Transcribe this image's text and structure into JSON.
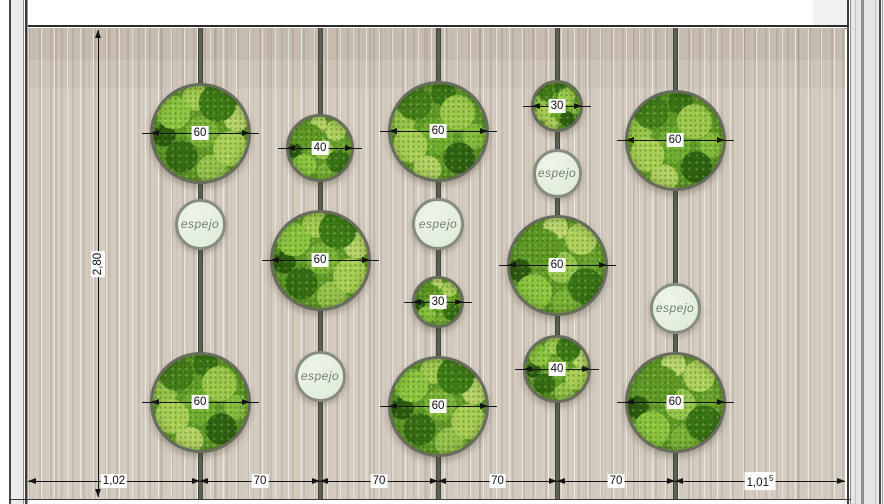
{
  "drawing": {
    "wall_height_dim": "2,80",
    "bottom_dims": [
      {
        "text": "1,02",
        "sup": ""
      },
      {
        "text": "70",
        "sup": ""
      },
      {
        "text": "70",
        "sup": ""
      },
      {
        "text": "70",
        "sup": ""
      },
      {
        "text": "70",
        "sup": ""
      },
      {
        "text": "1,01",
        "sup": "5"
      }
    ],
    "mirror_label": "espejo",
    "moss_diameter_labels": [
      "60",
      "40",
      "30"
    ]
  },
  "panels": [
    {
      "column": 1,
      "type": "moss",
      "label": "60",
      "cx": 200,
      "cy": 133,
      "d": 101
    },
    {
      "column": 1,
      "type": "mirror",
      "label": "espejo",
      "cx": 200,
      "cy": 224,
      "d": 51
    },
    {
      "column": 1,
      "type": "moss",
      "label": "60",
      "cx": 200,
      "cy": 402,
      "d": 101
    },
    {
      "column": 2,
      "type": "moss",
      "label": "40",
      "cx": 320,
      "cy": 148,
      "d": 68
    },
    {
      "column": 2,
      "type": "moss",
      "label": "60",
      "cx": 320,
      "cy": 260,
      "d": 101
    },
    {
      "column": 2,
      "type": "mirror",
      "label": "espejo",
      "cx": 320,
      "cy": 376,
      "d": 51
    },
    {
      "column": 3,
      "type": "moss",
      "label": "60",
      "cx": 438,
      "cy": 131,
      "d": 101
    },
    {
      "column": 3,
      "type": "mirror",
      "label": "espejo",
      "cx": 438,
      "cy": 224,
      "d": 52
    },
    {
      "column": 3,
      "type": "moss",
      "label": "30",
      "cx": 438,
      "cy": 302,
      "d": 52
    },
    {
      "column": 3,
      "type": "moss",
      "label": "60",
      "cx": 438,
      "cy": 406,
      "d": 101
    },
    {
      "column": 4,
      "type": "moss",
      "label": "30",
      "cx": 557,
      "cy": 106,
      "d": 52
    },
    {
      "column": 4,
      "type": "mirror",
      "label": "espejo",
      "cx": 557,
      "cy": 173,
      "d": 49
    },
    {
      "column": 4,
      "type": "moss",
      "label": "60",
      "cx": 557,
      "cy": 265,
      "d": 101
    },
    {
      "column": 4,
      "type": "moss",
      "label": "40",
      "cx": 557,
      "cy": 369,
      "d": 68
    },
    {
      "column": 5,
      "type": "moss",
      "label": "60",
      "cx": 675,
      "cy": 140,
      "d": 101
    },
    {
      "column": 5,
      "type": "mirror",
      "label": "espejo",
      "cx": 675,
      "cy": 308,
      "d": 51
    },
    {
      "column": 5,
      "type": "moss",
      "label": "60",
      "cx": 675,
      "cy": 402,
      "d": 101
    }
  ],
  "geometry": {
    "canvas": {
      "width": 884,
      "height": 504
    },
    "wall": {
      "left": 28,
      "top": 28,
      "right": 845,
      "bottom": 499
    },
    "rail_x": [
      200,
      320,
      438,
      557,
      675
    ],
    "bottom_dim_y": 481,
    "left_dim_x": 98,
    "left_dim_top": 30,
    "left_dim_bottom": 497,
    "height_label_y": 264
  },
  "colors": {
    "wall_base": "#d5ccc1",
    "rail": "#5c5f53",
    "moss_border": "#676c5c",
    "moss_greens": [
      "#8cc63f",
      "#3e7c16",
      "#a9cf54",
      "#6fae2f",
      "#2c5c0e",
      "#b7d468"
    ],
    "mirror_fill": "#e6efe0",
    "mirror_border": "#878c82",
    "dimension": "#141414"
  }
}
